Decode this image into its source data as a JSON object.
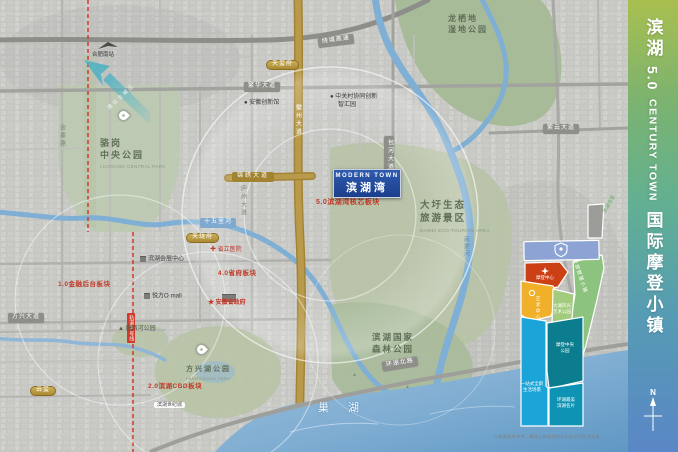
{
  "sidebar": {
    "zh1": "滨湖",
    "num": "5.0",
    "en": "CENTURY TOWN",
    "zh2": "国际摩登小镇",
    "compass": "N"
  },
  "project": {
    "en": "MODERN TOWN",
    "cn": "滨湖湾",
    "sector": "5.0滨湖湾核芯板块"
  },
  "water": {
    "lake": "巢 湖",
    "nanfei": "南淝河",
    "shiwuli": "十五里河"
  },
  "parks": {
    "longxidi1": "龙栖地",
    "longxidi2": "湿地公园",
    "luogang1": "骆岗",
    "luogang2": "中央公园",
    "luogang_en": "LUOGANG CENTRAL PARK",
    "daxu1": "大圩生态",
    "daxu2": "旅游景区",
    "daxu_en": "DAWEI ECO-TOURISM AREA",
    "forest1": "滨湖国家",
    "forest2": "森林公园",
    "fangxing": "方兴湖公园",
    "fangxing_en": "FANGXINGHU PARK",
    "tangxi": "▲ 塘西河公园",
    "tree": "▲"
  },
  "roads": {
    "raocheng": "绕城高速",
    "ziyun": "紫云大道",
    "fanhua": "繁华大道",
    "jinxiu": "锦绣大道",
    "huanhu": "环湖北路",
    "fangxing": "方兴大道",
    "huizhou": "徽州大道",
    "luzhou": "庐州大道",
    "baohe": "包河大道",
    "jinzhai": "金寨路",
    "metro": "轨道5号线"
  },
  "pois": {
    "innovation": "● 安徽创新馆",
    "zgc1": "● 中关村协同创新",
    "zgc2": "智汇园",
    "hospital": "✚ 省立医院",
    "gov": "★ 安徽省政府",
    "expo": "滨湖会展中心",
    "mall": "悦方O·mall",
    "station": "合肥南站",
    "century": "滨湖世纪城"
  },
  "sectors": {
    "s1": "1.0金融后台板块",
    "s4": "4.0省府板块",
    "s2": "2.0滨湖CBD板块"
  },
  "branded": {
    "b1": "天玺府",
    "b2": "天珑府",
    "b3": "云玺"
  },
  "arrow": "通往主城区",
  "inset": {
    "red": "摩登中心",
    "yellow": "艺术中心",
    "midgreen1": "大湖风光",
    "midgreen2": "艺术公园",
    "tallgreen": "总部智慧小镇",
    "cyan1": "一站式全龄",
    "cyan2": "生活场景",
    "teal1": "摩登中央",
    "teal2": "公园",
    "bteal1": "环湖最美",
    "bteal2": "滨湖名片",
    "note": "滨湖湾里",
    "caption": "示意图仅供参考，最终以政府规划及实际交付信息为准"
  },
  "colors": {
    "sidebar_top": "#a9bf4f",
    "sidebar_mid": "#62b092",
    "sidebar_bottom": "#5a87c6",
    "project_blue": "#1f4a9c",
    "metro_red": "#cf3a2a",
    "gold_road": "#b29040",
    "park_green": "#b5c2a6",
    "water_blue": "#86b2d4",
    "inset_cyan": "#1ba4d8",
    "inset_teal": "#0c7d8e",
    "inset_red": "#cc4015",
    "inset_yellow": "#f0b02a"
  }
}
